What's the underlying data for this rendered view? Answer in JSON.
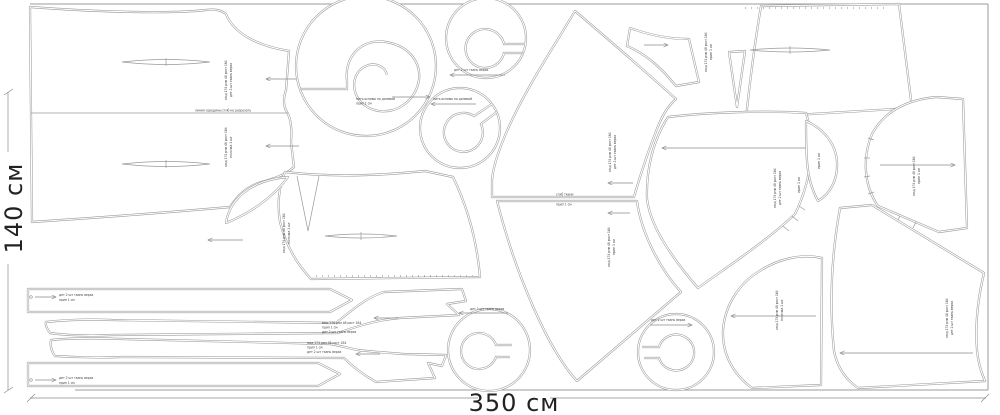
{
  "diagram_type": "sewing pattern cutting marker layout",
  "dimensions": {
    "height_label": "140 см",
    "width_label": "350 см"
  },
  "colors": {
    "background": "#ffffff",
    "line": "#9a9a9a",
    "text": "#222222"
  },
  "micro": {
    "m1": "нить основы по долевой",
    "m2": "мод 174 рзм 48 рост 164",
    "m3": "дет 2 шт ткань верха",
    "m4": "сгиб ткани",
    "m5": "линия середины сгиб не разрезать",
    "m6": "прип 1 см",
    "m7": "полочка 1 шт",
    "m8": "спинка со сгибом"
  },
  "pieces": [
    {
      "name": "dress-panel-on-fold"
    },
    {
      "name": "large-spiral-flounce"
    },
    {
      "name": "small-spiral-flounce-top"
    },
    {
      "name": "small-spiral-flounce-mid"
    },
    {
      "name": "skirt-gore-upper"
    },
    {
      "name": "skirt-gore-lower"
    },
    {
      "name": "side-skirt-panel"
    },
    {
      "name": "yoke-trapezoid"
    },
    {
      "name": "collar-wedge"
    },
    {
      "name": "dart-wedge"
    },
    {
      "name": "neckband-crescent"
    },
    {
      "name": "sleeve"
    },
    {
      "name": "side-bodice"
    },
    {
      "name": "back-skirt-panel"
    },
    {
      "name": "front-bodice"
    },
    {
      "name": "neck-facing-petal"
    },
    {
      "name": "belt-strip-top"
    },
    {
      "name": "sash-tie-upper"
    },
    {
      "name": "sash-tie-lower"
    },
    {
      "name": "belt-strip-bottom"
    },
    {
      "name": "hem-spiral-flounce"
    },
    {
      "name": "small-spiral-flounce-bottom"
    }
  ]
}
